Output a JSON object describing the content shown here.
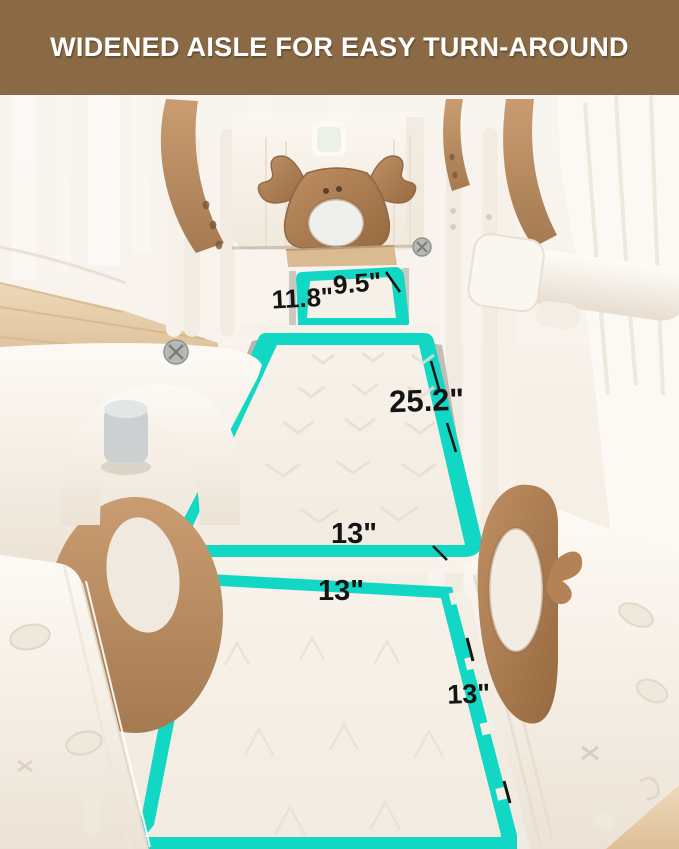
{
  "banner": {
    "title": "WIDENED AISLE FOR EASY TURN-AROUND"
  },
  "measurements": {
    "aisle_entry_width": "9.5\"",
    "aisle_entry_depth": "11.8\"",
    "aisle_length": "25.2\"",
    "aisle_width": "13\"",
    "mat_width": "13\"",
    "mat_side_length": "13\""
  },
  "colors": {
    "banner_brown": "#8a6a45",
    "highlight_teal": "#12d7c4",
    "label_color": "#141414",
    "accent_brown": "#bf9067",
    "playset_white": "#f8f3ec",
    "floor_wood": "#e6cda9"
  }
}
